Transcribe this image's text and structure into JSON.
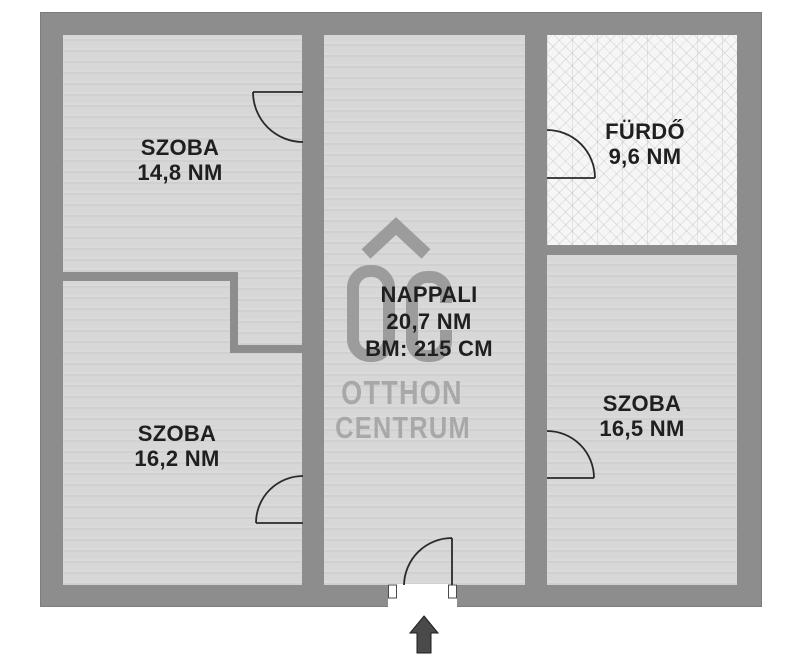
{
  "floorplan": {
    "rooms": [
      {
        "name": "SZOBA",
        "area": "14,8 NM"
      },
      {
        "name": "SZOBA",
        "area": "16,2 NM"
      },
      {
        "name": "NAPPALI",
        "area": "20,7 NM",
        "ceiling_height": "BM: 215 CM"
      },
      {
        "name": "FÜRDŐ",
        "area": "9,6 NM"
      },
      {
        "name": "SZOBA",
        "area": "16,5 NM"
      }
    ],
    "watermark": {
      "brand_line1": "OTTHON",
      "brand_line2": "CENTRUM"
    },
    "icons": {
      "entrance_arrow": "up-arrow",
      "logo_mark": "otthon-centrum-oc-roof"
    },
    "colors": {
      "background": "#ffffff",
      "wall": "#8d8d8d",
      "floor": "#d7d7d7",
      "bath_floor": "#f6f6f6",
      "door_line": "#2a2a2a",
      "label_text": "#1f1f1f",
      "logo_gray": "#9c9c9c",
      "watermark_gray": "#a8a8a8",
      "arrow": "#4a4a4a"
    }
  }
}
